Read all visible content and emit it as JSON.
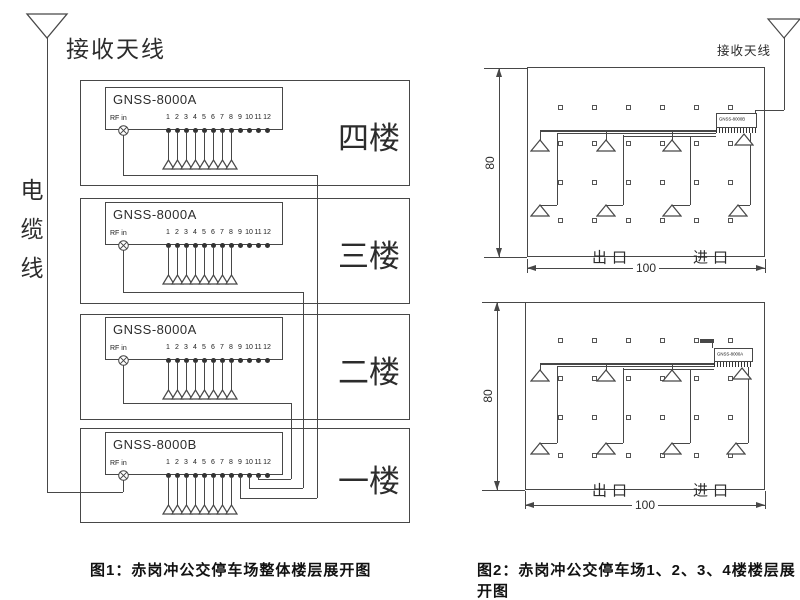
{
  "figure1": {
    "caption": "图1：赤岗冲公交停车场整体楼层展开图",
    "antenna_label": "接收天线",
    "cable_label": "电缆线",
    "rf_in_label": "RF in",
    "port_numbers": [
      "1",
      "2",
      "3",
      "4",
      "5",
      "6",
      "7",
      "8",
      "9",
      "10",
      "11",
      "12"
    ],
    "floors": [
      {
        "unit": "GNSS-8000A",
        "floor_label": "四楼"
      },
      {
        "unit": "GNSS-8000A",
        "floor_label": "三楼"
      },
      {
        "unit": "GNSS-8000A",
        "floor_label": "二楼"
      },
      {
        "unit": "GNSS-8000B",
        "floor_label": "一楼"
      }
    ]
  },
  "figure2": {
    "caption": "图2：赤岗冲公交停车场1、2、3、4楼楼层展开图",
    "antenna_label": "接收天线",
    "plans": [
      {
        "unit": "GNSS-8000B",
        "height_dim": "80",
        "width_dim": "100",
        "exit_label": "出口",
        "entrance_label": "进口"
      },
      {
        "unit": "GNSS-8000A",
        "height_dim": "80",
        "width_dim": "100",
        "exit_label": "出口",
        "entrance_label": "进口"
      }
    ]
  },
  "colors": {
    "line": "#474747",
    "text": "#222222",
    "background": "#ffffff"
  }
}
